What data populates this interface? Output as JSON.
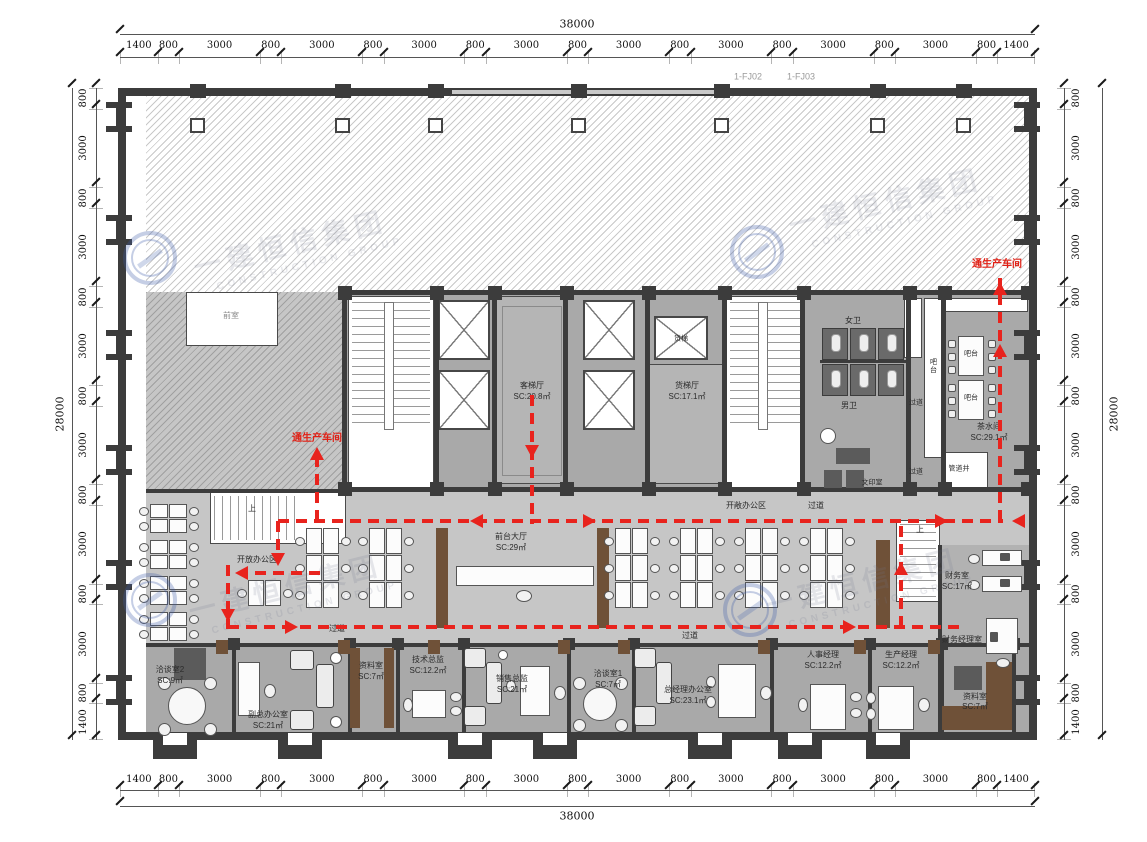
{
  "colors": {
    "route_red": "#e8231d",
    "wall_dark": "#3c3c3c",
    "floor_core": "#a9a9a9",
    "floor_mid": "#c6c6c6",
    "floor_office": "#a9a9a9",
    "wood_brown": "#6f5138",
    "watermark_blue": "#3e5eaa"
  },
  "dimensions": {
    "top": {
      "total": "38000",
      "segments": [
        1400,
        800,
        3000,
        800,
        3000,
        800,
        3000,
        800,
        3000,
        800,
        3000,
        800,
        3000,
        800,
        3000,
        800,
        3000,
        800,
        1400
      ]
    },
    "bottom": {
      "total": "38000",
      "segments": [
        1400,
        800,
        3000,
        800,
        3000,
        800,
        3000,
        800,
        3000,
        800,
        3000,
        800,
        3000,
        800,
        3000,
        800,
        3000,
        800,
        1400
      ]
    },
    "left": {
      "total": "28000",
      "segments": [
        800,
        3000,
        800,
        3000,
        800,
        3000,
        800,
        3000,
        800,
        3000,
        800,
        3000,
        800,
        1400
      ]
    },
    "right": {
      "total": "28000",
      "segments": [
        800,
        3000,
        800,
        3000,
        800,
        3000,
        800,
        3000,
        800,
        3000,
        800,
        3000,
        800,
        1400
      ]
    }
  },
  "annotations": [
    {
      "name": "grid-label-fj02",
      "text": "1-FJ02",
      "x": 748,
      "y": 77,
      "size": 9,
      "color": "#9a9a9a"
    },
    {
      "name": "grid-label-fj03",
      "text": "1-FJ03",
      "x": 801,
      "y": 77,
      "size": 9,
      "color": "#9a9a9a"
    },
    {
      "name": "vestibule-label",
      "text": "前室",
      "x": 231,
      "y": 316,
      "size": 8,
      "color": "#8a8a8a"
    },
    {
      "name": "passenger-lift-hall-label",
      "text": "客梯厅",
      "x": 532,
      "y": 386
    },
    {
      "name": "passenger-lift-hall-area",
      "text": "SC:20.8㎡",
      "x": 532,
      "y": 397
    },
    {
      "name": "freight-lift-hall-label",
      "text": "货梯厅",
      "x": 687,
      "y": 386
    },
    {
      "name": "freight-lift-hall-area",
      "text": "SC:17.1㎡",
      "x": 687,
      "y": 397
    },
    {
      "name": "freight-lift-label",
      "text": "货梯",
      "x": 681,
      "y": 339,
      "size": 7
    },
    {
      "name": "womens-toilet-label",
      "text": "女卫",
      "x": 853,
      "y": 321
    },
    {
      "name": "mens-toilet-label",
      "text": "男卫",
      "x": 849,
      "y": 406
    },
    {
      "name": "corridor-label-core-1",
      "text": "过道",
      "x": 916,
      "y": 403,
      "size": 7
    },
    {
      "name": "corridor-label-core-2",
      "text": "过道",
      "x": 916,
      "y": 472,
      "size": 7
    },
    {
      "name": "bar-counter-label",
      "text": "吧台",
      "x": 933,
      "y": 366,
      "size": 7,
      "vert": true
    },
    {
      "name": "bar-table-label-1",
      "text": "吧台",
      "x": 971,
      "y": 354,
      "size": 7
    },
    {
      "name": "bar-table-label-2",
      "text": "吧台",
      "x": 971,
      "y": 398,
      "size": 7
    },
    {
      "name": "tea-room-label",
      "text": "茶水间",
      "x": 989,
      "y": 427
    },
    {
      "name": "tea-room-area",
      "text": "SC:29.1㎡",
      "x": 989,
      "y": 438
    },
    {
      "name": "pipe-shaft-label",
      "text": "管道井",
      "x": 959,
      "y": 469,
      "size": 7
    },
    {
      "name": "print-room-label",
      "text": "文印室",
      "x": 872,
      "y": 483,
      "size": 7
    },
    {
      "name": "open-office-zone-label",
      "text": "开敞办公区",
      "x": 746,
      "y": 506
    },
    {
      "name": "corridor-label-top",
      "text": "过道",
      "x": 816,
      "y": 506
    },
    {
      "name": "stair-up-label-1",
      "text": "上",
      "x": 252,
      "y": 509
    },
    {
      "name": "open-office-area-label",
      "text": "开放办公区",
      "x": 257,
      "y": 560
    },
    {
      "name": "reception-hall-label",
      "text": "前台大厅",
      "x": 511,
      "y": 537
    },
    {
      "name": "reception-hall-area",
      "text": "SC:29㎡",
      "x": 511,
      "y": 548
    },
    {
      "name": "stair-up-label-2",
      "text": "上",
      "x": 920,
      "y": 530
    },
    {
      "name": "finance-room-label",
      "text": "财务室",
      "x": 957,
      "y": 576
    },
    {
      "name": "finance-room-area",
      "text": "SC:17㎡",
      "x": 957,
      "y": 587
    },
    {
      "name": "corridor-label-bottom-1",
      "text": "过道",
      "x": 337,
      "y": 629
    },
    {
      "name": "corridor-label-bottom-2",
      "text": "过道",
      "x": 690,
      "y": 636
    },
    {
      "name": "finance-manager-room-label",
      "text": "财务经理室",
      "x": 962,
      "y": 640
    },
    {
      "name": "meeting-room-2-label",
      "text": "洽谈室2",
      "x": 170,
      "y": 670
    },
    {
      "name": "meeting-room-2-area",
      "text": "SC:9㎡",
      "x": 170,
      "y": 681
    },
    {
      "name": "deputy-gm-office-label",
      "text": "副总办公室",
      "x": 268,
      "y": 715
    },
    {
      "name": "deputy-gm-office-area",
      "text": "SC:21㎡",
      "x": 268,
      "y": 726
    },
    {
      "name": "archive-room-1-label",
      "text": "资料室",
      "x": 371,
      "y": 666
    },
    {
      "name": "archive-room-1-area",
      "text": "SC:7㎡",
      "x": 371,
      "y": 677
    },
    {
      "name": "technical-director-label",
      "text": "技术总监",
      "x": 428,
      "y": 660
    },
    {
      "name": "technical-director-area",
      "text": "SC:12.2㎡",
      "x": 428,
      "y": 671
    },
    {
      "name": "sales-director-label",
      "text": "销售总监",
      "x": 512,
      "y": 679
    },
    {
      "name": "sales-director-area",
      "text": "SC:21㎡",
      "x": 512,
      "y": 690
    },
    {
      "name": "meeting-room-1-label",
      "text": "洽谈室1",
      "x": 608,
      "y": 674
    },
    {
      "name": "meeting-room-1-area",
      "text": "SC:7㎡",
      "x": 608,
      "y": 685
    },
    {
      "name": "gm-office-label",
      "text": "总经理办公室",
      "x": 688,
      "y": 690
    },
    {
      "name": "gm-office-area",
      "text": "SC:23.1㎡",
      "x": 688,
      "y": 701
    },
    {
      "name": "hr-manager-label",
      "text": "人事经理",
      "x": 823,
      "y": 655
    },
    {
      "name": "hr-manager-area",
      "text": "SC:12.2㎡",
      "x": 823,
      "y": 666
    },
    {
      "name": "production-manager-label",
      "text": "生产经理",
      "x": 901,
      "y": 655
    },
    {
      "name": "production-manager-area",
      "text": "SC:12.2㎡",
      "x": 901,
      "y": 666
    },
    {
      "name": "archive-room-2-label",
      "text": "资料室",
      "x": 975,
      "y": 697
    },
    {
      "name": "archive-room-2-area",
      "text": "SC:7㎡",
      "x": 975,
      "y": 707
    }
  ],
  "route": {
    "color": "#e8231d",
    "labels": [
      {
        "name": "to-production-workshop-label-left",
        "text": "通生产车间",
        "x": 317,
        "y": 439
      },
      {
        "name": "to-production-workshop-label-right",
        "text": "通生产车间",
        "x": 997,
        "y": 265
      }
    ]
  },
  "watermark": {
    "text": "一建恒信集团",
    "subtext": "CONSTRUCTION GROUP"
  }
}
